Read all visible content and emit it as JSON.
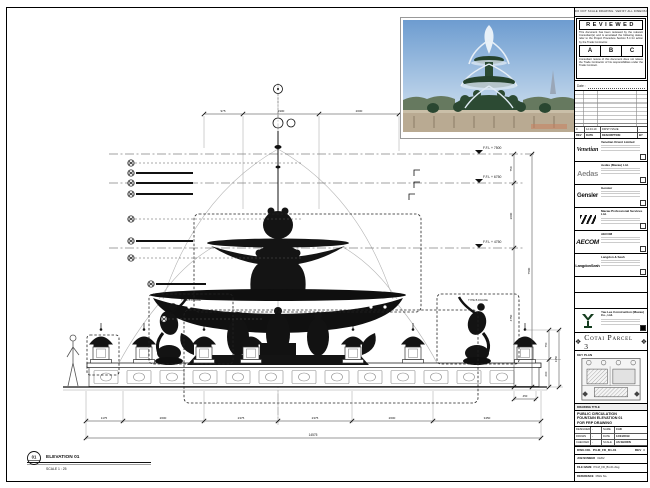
{
  "top_strip": {
    "note": "DO NOT SCALE DRAWING. VERIFY ALL DIMENSIONS ON SITE. REPORT ANY DISCREPANCY."
  },
  "stamp": {
    "title": "REVIEWED",
    "body": "This document has been reviewed by the relevant Consultant(s) and is annotated the following status, refer to the Project Procedure Section 5.4 for action by the Trade Contractor.",
    "options": {
      "a": "A",
      "b": "B",
      "c": "C"
    },
    "note": "Consultant review of this document does not relieve the Trade Contractor of his responsibilities under the Trade Contract.",
    "date_label": "Date :"
  },
  "revision_table": {
    "cols": {
      "rev": "REV",
      "date": "DATE",
      "desc": "DESCRIPTION",
      "by": "BY"
    },
    "entry": {
      "rev": "0",
      "date": "12.04.19",
      "desc": "FIRST ISSUE",
      "by": "-"
    }
  },
  "consultants": [
    {
      "logo_text": "Venetian",
      "name": "Venetian Orient Limited"
    },
    {
      "logo_text": "Aedas",
      "name": "Aedas (Macau) Ltd."
    },
    {
      "logo_text": "Gensler",
      "name": "Gensler"
    },
    {
      "logo_text": "",
      "name": "Macau Professional Services Ltd."
    },
    {
      "logo_text": "AECOM",
      "name": "AECOM"
    },
    {
      "logo_text": "LangdonSeah",
      "name": "Langdon & Seah"
    }
  ],
  "contractor": {
    "name": "Yau Lee Construction (Macau) Co., Ltd."
  },
  "project": {
    "title": "Cotai Parcel 3",
    "emblem": "❖"
  },
  "key_plan": {
    "label": "KEY PLAN"
  },
  "title_block": {
    "header": "DRAWING TITLE",
    "line1": "PUBLIC CIRCULATION",
    "line2": "FOUNTAIN ELEVATION 01",
    "line3": "FOR FRP DRAWING",
    "designed_label": "DESIGNED",
    "designed_value": "-",
    "drawn_label": "DRAWN",
    "drawn_value": "-",
    "checked_label": "CHECKED",
    "checked_value": "-",
    "name_label": "NAME",
    "name_value": "CAD",
    "date_label": "DATE",
    "date_value": "12/04/2019",
    "scale_label": "SCALE",
    "scale_value": "AS SHOWN",
    "dwg_label": "DWG NO.",
    "dwg_value": "P3-M_FD_B1-01",
    "rev_label": "REV",
    "rev_value": "0",
    "job_label": "JOB NUMBER",
    "job_value": "31202",
    "file_label": "FILE NAME",
    "file_value": "P3-M_FD_B1-01.dwg",
    "ref_label": "REFERENCE",
    "ref_value": "DWG No."
  },
  "drawing": {
    "elevation_marker": "01",
    "elevation_label": "ELEVATION 01",
    "scale_label": "SCALE 1 : 25",
    "callout_label": "TYPE B FIGURE",
    "levels": {
      "ffl7500": "F.F.L + 7500",
      "ffl6750": "F.F.L + 6750",
      "ffl4750": "F.F.L + 4750",
      "ffl0": "F.F.L."
    },
    "dims": {
      "t1": "975",
      "t2": "1900",
      "t3": "2000",
      "v1": "750",
      "v2": "2000",
      "v3": "4750",
      "vt": "7500",
      "p1": "750",
      "p2": "600",
      "pt": "1350",
      "pb": "450",
      "b1": "1175",
      "b2": "2600",
      "b3": "2375",
      "b4": "2375",
      "b5": "2600",
      "b6": "3450",
      "bt": "14575"
    }
  },
  "colors": {
    "sky_top": "#6d9cd0",
    "sky_bottom": "#dcE9f4",
    "bronze_green": "#24452e",
    "stone": "#b9aa92"
  }
}
